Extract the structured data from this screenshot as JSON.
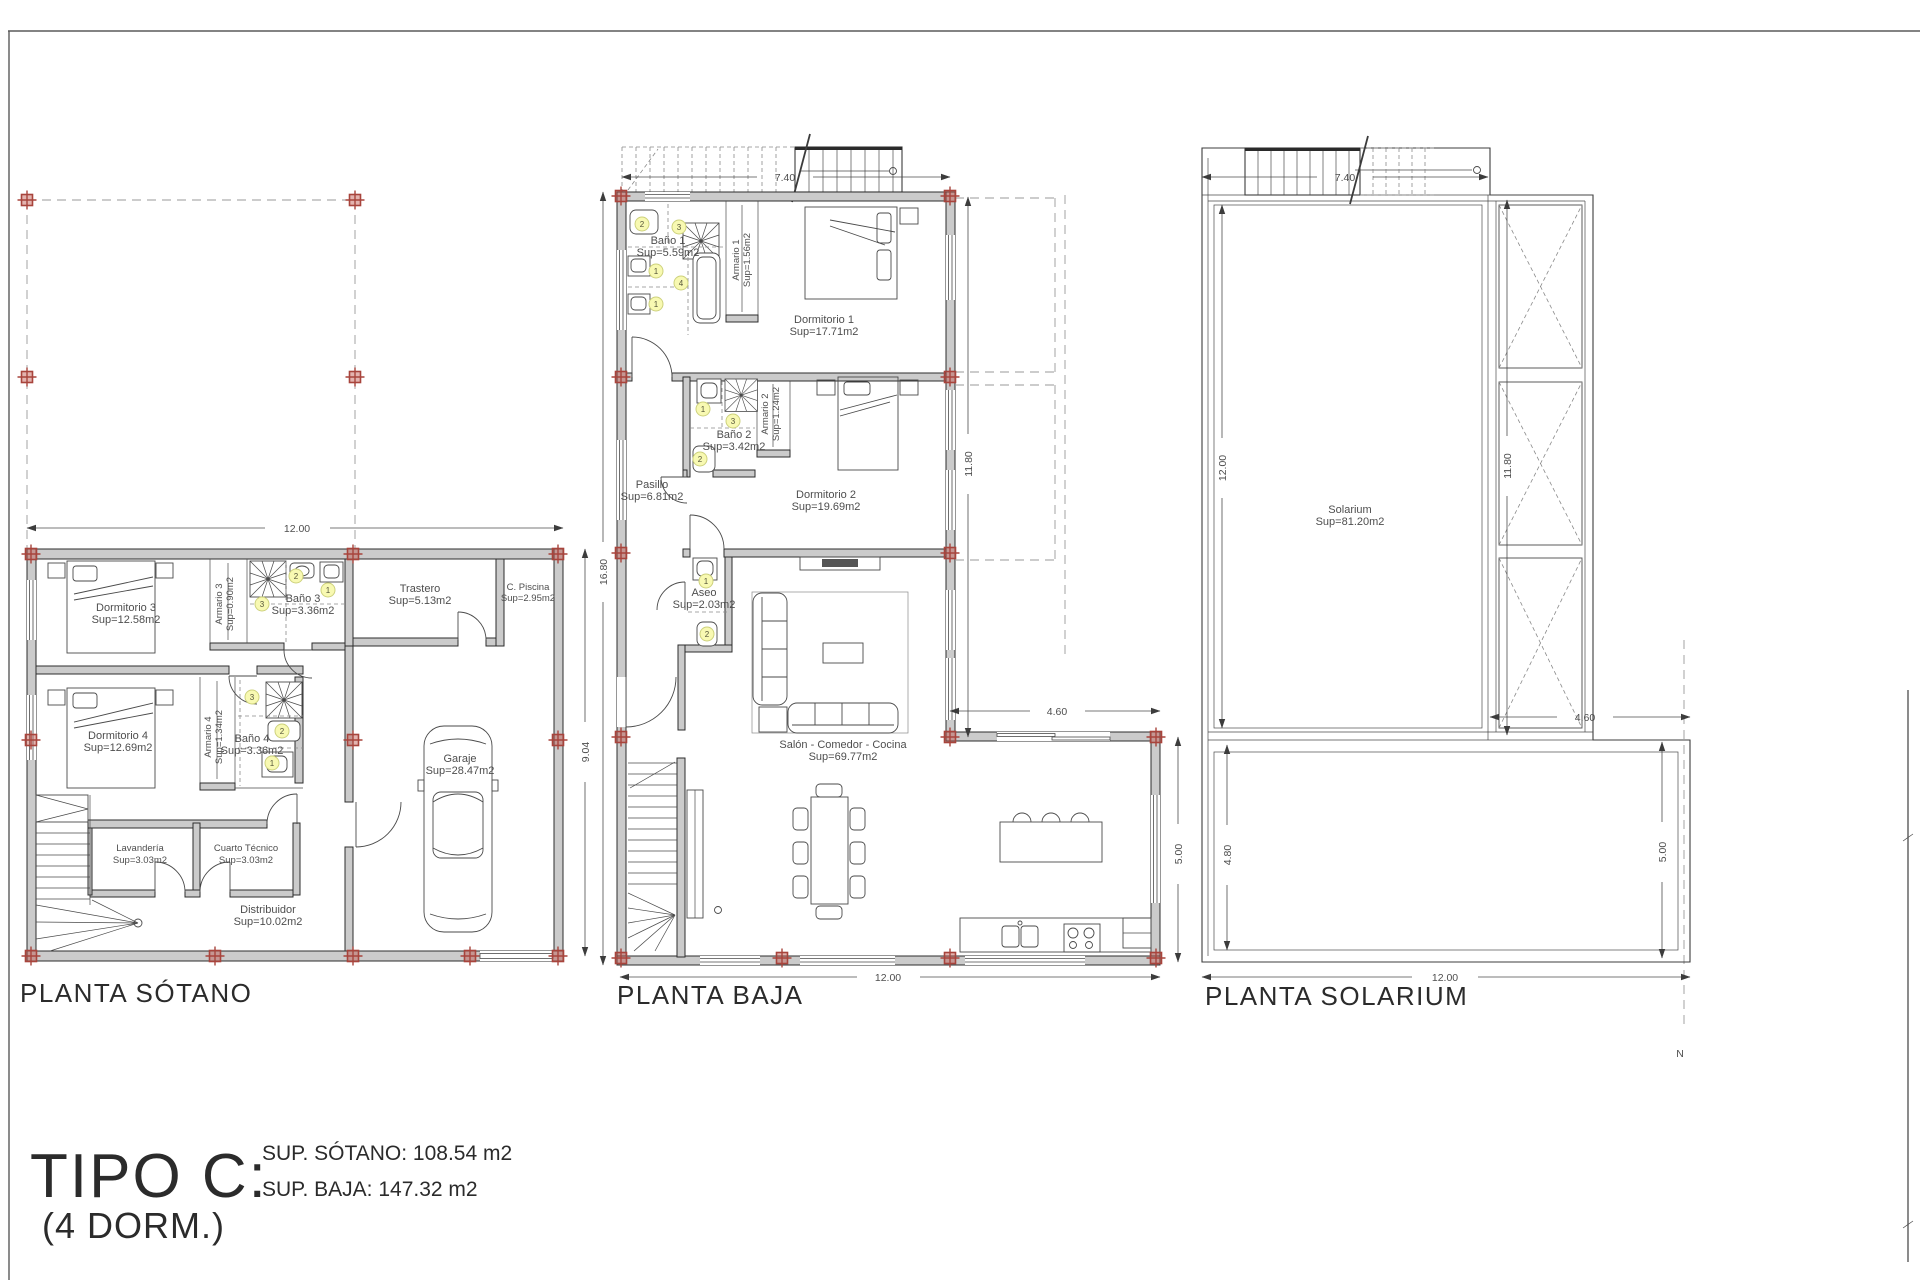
{
  "sheet": {
    "title_block": {
      "type_label": "TIPO C:",
      "dorm_label": "(4 DORM.)",
      "sup_sotano": "SUP. SÓTANO: 108.54 m2",
      "sup_baja": "SUP. BAJA: 147.32 m2"
    },
    "north_label": "N",
    "colors": {
      "wall_fill": "#cbcbcb",
      "line": "#3c3c3c",
      "column_marker_red": "#a8443c",
      "fixture_tag_yellow": "#f8f9b2",
      "projection_dash_gray": "#9a9a9a"
    }
  },
  "fixture_tags": {
    "one": "1",
    "two": "2",
    "three": "3",
    "four": "4"
  },
  "plans": {
    "sotano": {
      "title": "PLANTA SÓTANO",
      "rooms": {
        "dormitorio3": {
          "name": "Dormitorio 3",
          "area": "Sup=12.58m2"
        },
        "armario3": {
          "name": "Armario 3",
          "area": "Sup=0.90m2"
        },
        "bano3": {
          "name": "Baño 3",
          "area": "Sup=3.36m2"
        },
        "trastero": {
          "name": "Trastero",
          "area": "Sup=5.13m2"
        },
        "cpiscina": {
          "name": "C. Piscina",
          "area": "Sup=2.95m2"
        },
        "dormitorio4": {
          "name": "Dormitorio 4",
          "area": "Sup=12.69m2"
        },
        "armario4": {
          "name": "Armario 4",
          "area": "Sup=1.34m2"
        },
        "bano4": {
          "name": "Baño 4",
          "area": "Sup=3.36m2"
        },
        "lavanderia": {
          "name": "Lavandería",
          "area": "Sup=3.03m2"
        },
        "cuarto_tecnico": {
          "name": "Cuarto Técnico",
          "area": "Sup=3.03m2"
        },
        "distribuidor": {
          "name": "Distribuidor",
          "area": "Sup=10.02m2"
        },
        "garaje": {
          "name": "Garaje",
          "area": "Sup=28.47m2"
        }
      },
      "dims": {
        "w": "12.00",
        "h": "9.04"
      }
    },
    "baja": {
      "title": "PLANTA BAJA",
      "rooms": {
        "bano1": {
          "name": "Baño 1",
          "area": "Sup=5.59m2"
        },
        "armario1": {
          "name": "Armario 1",
          "area": "Sup=1.56m2"
        },
        "dormitorio1": {
          "name": "Dormitorio 1",
          "area": "Sup=17.71m2"
        },
        "bano2": {
          "name": "Baño 2",
          "area": "Sup=3.42m2"
        },
        "armario2": {
          "name": "Armario 2",
          "area": "Sup=1.24m2"
        },
        "dormitorio2": {
          "name": "Dormitorio 2",
          "area": "Sup=19.69m2"
        },
        "pasillo": {
          "name": "Pasillo",
          "area": "Sup=6.81m2"
        },
        "aseo": {
          "name": "Aseo",
          "area": "Sup=2.03m2"
        },
        "salon": {
          "name": "Salón - Comedor - Cocina",
          "area": "Sup=69.77m2"
        }
      },
      "dims": {
        "top": "7.40",
        "left": "16.80",
        "right": "11.80",
        "kitchen_w": "4.60",
        "kitchen_h": "5.00",
        "bottom": "12.00"
      }
    },
    "solarium": {
      "title": "PLANTA SOLARIUM",
      "rooms": {
        "solarium": {
          "name": "Solarium",
          "area": "Sup=81.20m2"
        }
      },
      "dims": {
        "top": "7.40",
        "left": "12.00",
        "mid": "11.80",
        "terrace_w": "4.60",
        "terrace_left": "4.80",
        "terrace_right": "5.00",
        "bottom": "12.00"
      }
    }
  }
}
